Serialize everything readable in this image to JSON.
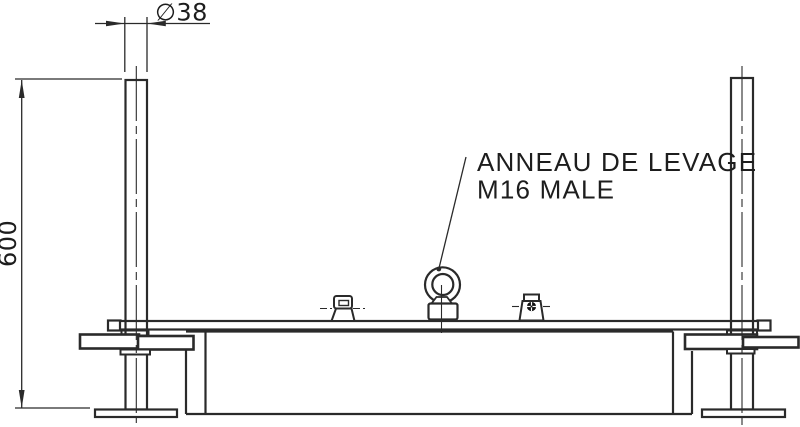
{
  "drawing": {
    "callout": {
      "line1": "ANNEAU DE LEVAGE",
      "line2": "M16 MALE"
    },
    "dimensions": {
      "diameter": "∅38",
      "height": "600"
    },
    "colors": {
      "background": "#ffffff",
      "line": "#2a2a2a",
      "text": "#1d1d1d"
    }
  }
}
